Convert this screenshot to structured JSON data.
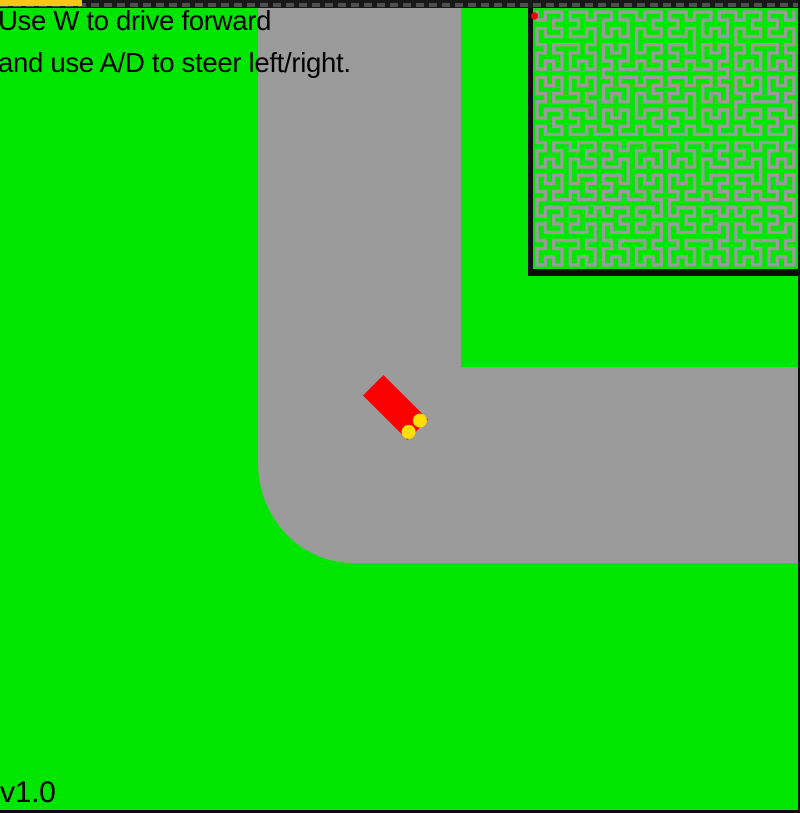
{
  "hud": {
    "instructions": [
      "Use W to drive forward",
      "and use A/D to steer left/right."
    ],
    "version": "v1.0"
  },
  "colors": {
    "grass": "#00e600",
    "road": "#9b9b9b",
    "car_body": "#fb0000",
    "car_lights": "#ffdf00",
    "progress_strip": "#eecd11",
    "minimap_dot": "#ee0000",
    "frame_black": "#0d0d0d",
    "top_bar_base": "#181818",
    "top_bar_dash": "#4f4f4f"
  },
  "car": {
    "x": 395.5,
    "y": 407.5,
    "angle_deg": -45,
    "width": 29,
    "length": 63
  },
  "minimap": {
    "type": "hilbert-curve",
    "order": 5,
    "track_stroke_width": 3.4,
    "dot": {
      "x": 534.5,
      "y": 16,
      "r": 3.6
    }
  }
}
